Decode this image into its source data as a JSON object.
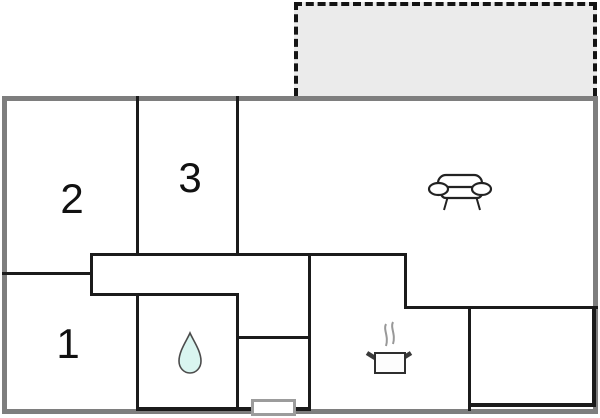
{
  "theme": {
    "outer_wall": "#7e7e7e",
    "inner_wall": "#1b1b1b",
    "terrace_fill": "#ebebeb",
    "terrace_border": "#141414",
    "window_border": "#9c9c9c",
    "drop_fill": "#d9f5f0",
    "drop_stroke": "#4c4c4c",
    "steam_color": "#989898",
    "icon_stroke": "#222222"
  },
  "floorplan": {
    "rooms": [
      {
        "label": "1"
      },
      {
        "label": "2"
      },
      {
        "label": "3"
      }
    ],
    "icons": [
      {
        "name": "sofa-icon"
      },
      {
        "name": "water-drop-icon"
      },
      {
        "name": "cooking-pot-icon"
      },
      {
        "name": "window-marker"
      },
      {
        "name": "terrace-area"
      }
    ]
  }
}
